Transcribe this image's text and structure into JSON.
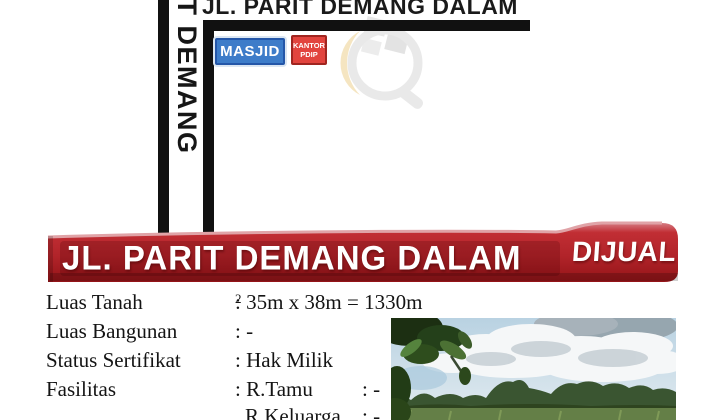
{
  "map": {
    "horizontal_road_label": "JL. PARIT DEMANG DALAM",
    "vertical_road_label": "PARIT DEMANG",
    "road_color": "#111111",
    "landmarks": {
      "masjid": {
        "label": "MASJID",
        "fill": "#3d7cc9",
        "border": "#2456a8"
      },
      "kantor_pdip": {
        "label_line1": "KANTOR",
        "label_line2": "PDIP",
        "fill": "#e2443e",
        "border": "#a02520"
      }
    }
  },
  "banner": {
    "street": "JL. PARIT DEMANG DALAM",
    "status": "DIJUAL",
    "fill": "#b2242a",
    "text_color": "#ffffff"
  },
  "details": {
    "rows": [
      {
        "label": "Luas Tanah",
        "value": ": 35m x 38m = 1330m",
        "sup": "2"
      },
      {
        "label": "Luas Bangunan",
        "value": ": -"
      },
      {
        "label": "Status Sertifikat",
        "value": ": Hak Milik"
      },
      {
        "label": "Fasilitas",
        "value": ": R.Tamu",
        "value2": ": -"
      },
      {
        "label": "",
        "value": "R.Keluarga",
        "value2": ": -"
      }
    ]
  },
  "photo": {
    "description": "vacant grassy land with trees and cloudy sky"
  }
}
